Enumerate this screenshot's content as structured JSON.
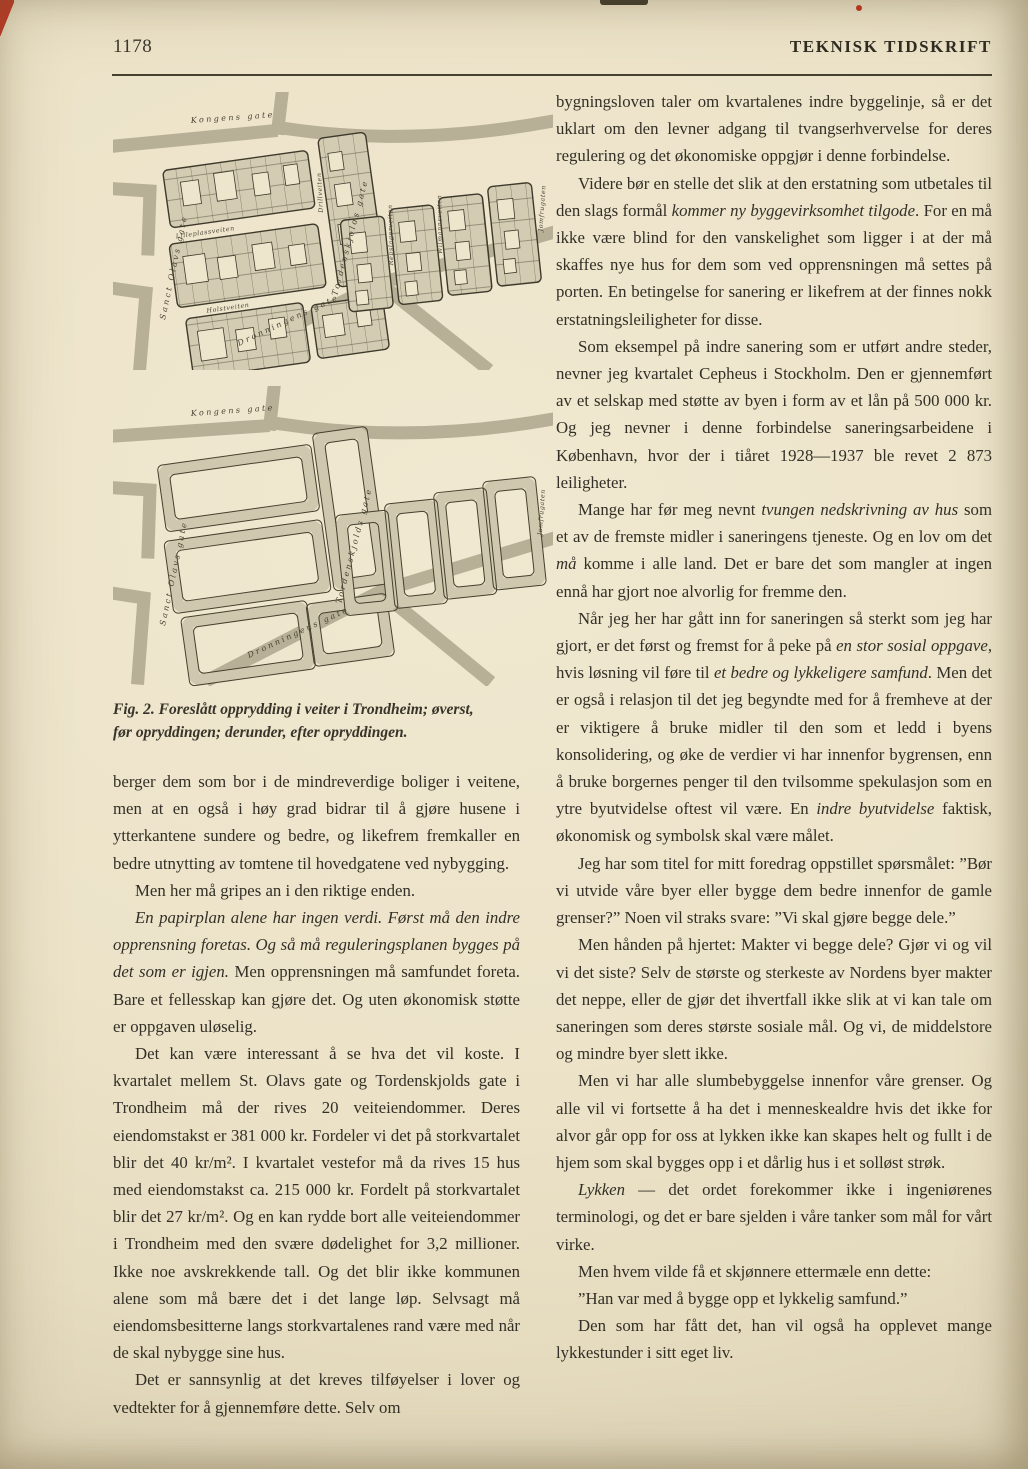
{
  "header": {
    "page_number": "1178",
    "journal_title": "TEKNISK TIDSKRIFT"
  },
  "artifacts": {
    "red": "#c23120",
    "ink": "#332f26",
    "paper": "#ece3c9"
  },
  "figure": {
    "caption_line1": "Fig. 2. Foreslått opprydding i veiter i Trondheim; øverst,",
    "caption_line2": "før opryddingen; derunder, efter opryddingen.",
    "map_labels": {
      "kongens": "Kongens gate",
      "sanct_olavs": "Sanct Olavs gate",
      "dronningens": "Dronningens gate",
      "tordenskjolds": "Tordenskjolds gate",
      "jomfru": "Jomfrugaten",
      "veit_lilleplass": "Lilleplassveiten",
      "veit_drill": "Drillveiten",
      "veit_holst": "Holstveiten",
      "veit_repslager": "Repslagerveiten",
      "veit_wilmanns": "Wilmannsveiten"
    }
  },
  "left_column": {
    "paragraphs": [
      {
        "indent": false,
        "segments": [
          {
            "text": "berger dem som bor i de mindreverdige boliger i veitene, men at en også i høy grad bidrar til å gjøre husene i ytterkantene sundere og bedre, og likefrem fremkaller en bedre utnytting av tomtene til hovedgatene ved nybygging.",
            "italic": false
          }
        ]
      },
      {
        "indent": true,
        "segments": [
          {
            "text": "Men her må gripes an i den riktige enden.",
            "italic": false
          }
        ]
      },
      {
        "indent": true,
        "segments": [
          {
            "text": "En papirplan alene har ingen verdi. Først må den indre opprensning foretas. Og så må reguleringsplanen bygges på det som er igjen.",
            "italic": true
          },
          {
            "text": " Men opprensningen må samfundet foreta. Bare et fellesskap kan gjøre det. Og uten økonomisk støtte er oppgaven uløselig.",
            "italic": false
          }
        ]
      },
      {
        "indent": true,
        "segments": [
          {
            "text": "Det kan være interessant å se hva det vil koste. I kvartalet mellem St. Olavs gate og Tordenskjolds gate i Trondheim må der rives 20 veiteiendommer. Deres eiendomstakst er 381 000 kr. Fordeler vi det på storkvartalet blir det 40 kr/m². I kvartalet vestefor må da rives 15 hus med eiendomstakst ca. 215 000 kr. Fordelt på storkvartalet blir det 27 kr/m². Og en kan rydde bort alle veiteiendommer i Trondheim med den svære dødelighet for 3,2 millioner. Ikke noe avskrekkende tall. Og det blir ikke kommunen alene som må bære det i det lange løp. Selvsagt må eiendomsbesitterne langs storkvartalenes rand være med når de skal nybygge sine hus.",
            "italic": false
          }
        ]
      },
      {
        "indent": true,
        "segments": [
          {
            "text": "Det er sannsynlig at det kreves tilføyelser i lover og vedtekter for å gjennemføre dette. Selv om",
            "italic": false
          }
        ]
      }
    ]
  },
  "right_column": {
    "paragraphs": [
      {
        "indent": false,
        "segments": [
          {
            "text": "bygningsloven taler om kvartalenes indre byggelinje, så er det uklart om den levner adgang til tvangserhvervelse for deres regulering og det økonomiske oppgjør i denne forbindelse.",
            "italic": false
          }
        ]
      },
      {
        "indent": true,
        "segments": [
          {
            "text": "Videre bør en stelle det slik at den erstatning som utbetales til den slags formål ",
            "italic": false
          },
          {
            "text": "kommer ny byggevirksomhet tilgode",
            "italic": true
          },
          {
            "text": ". For en må ikke være blind for den vanskelighet som ligger i at der må skaffes nye hus for dem som ved opprensningen må settes på porten. En betingelse for sanering er likefrem at der finnes nokk erstatningsleiligheter for disse.",
            "italic": false
          }
        ]
      },
      {
        "indent": true,
        "segments": [
          {
            "text": "Som eksempel på indre sanering som er utført andre steder, nevner jeg kvartalet Cepheus i Stockholm. Den er gjennemført av et selskap med støtte av byen i form av et lån på 500 000 kr. Og jeg nevner i denne forbindelse saneringsarbeidene i København, hvor der i tiåret 1928—1937 ble revet 2 873 leiligheter.",
            "italic": false
          }
        ]
      },
      {
        "indent": true,
        "segments": [
          {
            "text": "Mange har før meg nevnt ",
            "italic": false
          },
          {
            "text": "tvungen nedskrivning av hus",
            "italic": true
          },
          {
            "text": " som et av de fremste midler i saneringens tjeneste. Og en lov om det ",
            "italic": false
          },
          {
            "text": "må",
            "italic": true
          },
          {
            "text": " komme i alle land. Det er bare det som mangler at ingen ennå har gjort noe alvorlig for fremme den.",
            "italic": false
          }
        ]
      },
      {
        "indent": true,
        "segments": [
          {
            "text": "Når jeg her har gått inn for saneringen så sterkt som jeg har gjort, er det først og fremst for å peke på ",
            "italic": false
          },
          {
            "text": "en stor sosial oppgave",
            "italic": true
          },
          {
            "text": ", hvis løsning vil føre til ",
            "italic": false
          },
          {
            "text": "et bedre og lykkeligere samfund",
            "italic": true
          },
          {
            "text": ". Men det er også i relasjon til det jeg begyndte med for å fremheve at der er viktigere å bruke midler til den som et ledd i byens konsolidering, og øke de verdier vi har innenfor bygrensen, enn å bruke borgernes penger til den tvilsomme spekulasjon som en ytre byutvidelse oftest vil være. En ",
            "italic": false
          },
          {
            "text": "indre byutvidelse",
            "italic": true
          },
          {
            "text": " faktisk, økonomisk og symbolsk skal være målet.",
            "italic": false
          }
        ]
      },
      {
        "indent": true,
        "segments": [
          {
            "text": "Jeg har som titel for mitt foredrag oppstillet spørsmålet: ”Bør vi utvide våre byer eller bygge dem bedre innenfor de gamle grenser?” Noen vil straks svare: ”Vi skal gjøre begge dele.”",
            "italic": false
          }
        ]
      },
      {
        "indent": true,
        "segments": [
          {
            "text": "Men hånden på hjertet: Makter vi begge dele? Gjør vi og vil vi det siste? Selv de største og sterkeste av Nordens byer makter det neppe, eller de gjør det ihvertfall ikke slik at vi kan tale om saneringen som deres største sosiale mål. Og vi, de middelstore og mindre byer slett ikke.",
            "italic": false
          }
        ]
      },
      {
        "indent": true,
        "segments": [
          {
            "text": "Men vi har alle slumbebyggelse innenfor våre grenser. Og alle vil vi fortsette å ha det i menneskealdre hvis det ikke for alvor går opp for oss at lykken ikke kan skapes helt og fullt i de hjem som skal bygges opp i et dårlig hus i et solløst strøk.",
            "italic": false
          }
        ]
      },
      {
        "indent": true,
        "segments": [
          {
            "text": "Lykken",
            "italic": true
          },
          {
            "text": " — det ordet forekommer ikke i ingeniørenes terminologi, og det er bare sjelden i våre tanker som mål for vårt virke.",
            "italic": false
          }
        ]
      },
      {
        "indent": true,
        "segments": [
          {
            "text": "Men hvem vilde få et skjønnere ettermæle enn dette:",
            "italic": false
          }
        ]
      },
      {
        "indent": true,
        "segments": [
          {
            "text": "”Han var med å bygge opp et lykkelig samfund.”",
            "italic": false
          }
        ]
      },
      {
        "indent": true,
        "segments": [
          {
            "text": "Den som har fått det, han vil også ha opplevet mange lykkestunder i sitt eget liv.",
            "italic": false
          }
        ]
      }
    ]
  }
}
